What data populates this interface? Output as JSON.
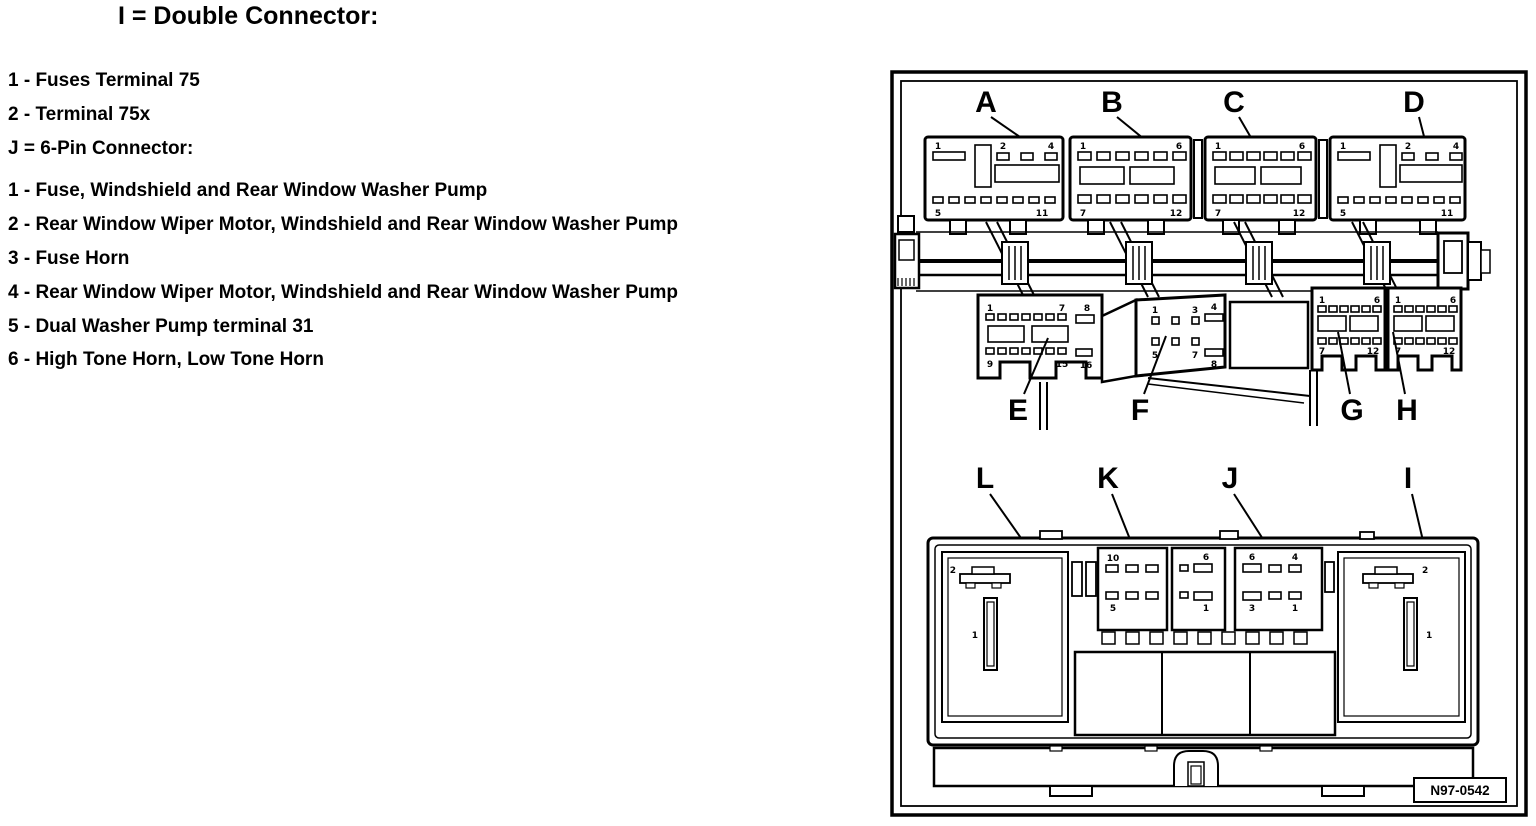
{
  "colors": {
    "ink": "#000000",
    "paper": "#ffffff"
  },
  "legend": {
    "header_double": "I = Double Connector:",
    "double_items": [
      "1 - Fuses Terminal 75",
      "2 - Terminal 75x"
    ],
    "header_6pin": "J = 6-Pin Connector:",
    "sixpin_items": [
      "1 - Fuse, Windshield and Rear Window Washer Pump",
      "2 - Rear Window Wiper Motor, Windshield and Rear Window Washer Pump",
      "3 - Fuse Horn",
      "4 - Rear Window Wiper Motor, Windshield and Rear Window Washer Pump",
      "5 - Dual Washer Pump terminal 31",
      "6 - High Tone Horn, Low Tone Horn"
    ]
  },
  "diagram": {
    "figure_number": "N97-0542",
    "top_connectors": {
      "a": "A",
      "b": "B",
      "c": "C",
      "d": "D"
    },
    "mid_connectors": {
      "e": "E",
      "f": "F",
      "g": "G",
      "h": "H"
    },
    "bottom_connectors": {
      "l": "L",
      "k": "K",
      "j": "J",
      "i": "I"
    },
    "pins": {
      "a": {
        "t1": "1",
        "t2": "2",
        "t3": "4",
        "b1": "5",
        "b2": "11"
      },
      "b": {
        "t1": "1",
        "t2": "6",
        "b1": "7",
        "b2": "12"
      },
      "c": {
        "t1": "1",
        "t2": "6",
        "b1": "7",
        "b2": "12"
      },
      "d": {
        "t1": "1",
        "t2": "2",
        "t3": "4",
        "b1": "5",
        "b2": "11"
      },
      "e": {
        "t1": "1",
        "t2": "7",
        "t3": "8",
        "b1": "9",
        "b2": "15",
        "b3": "16"
      },
      "f": {
        "t1": "1",
        "t2": "3",
        "t3": "4",
        "b1": "5",
        "b2": "7",
        "b3": "8"
      },
      "g": {
        "t1": "1",
        "t2": "6",
        "b1": "7",
        "b2": "12"
      },
      "h": {
        "t1": "1",
        "t2": "6",
        "b1": "7",
        "b2": "12"
      },
      "k": {
        "t1": "10",
        "b1": "5"
      },
      "m": {
        "t1": "6",
        "b1": "1"
      },
      "j": {
        "t1": "6",
        "t2": "4",
        "b1": "3",
        "b2": "1"
      },
      "l": {
        "p2": "2",
        "p1": "1"
      },
      "i": {
        "p2": "2",
        "p1": "1"
      }
    }
  }
}
